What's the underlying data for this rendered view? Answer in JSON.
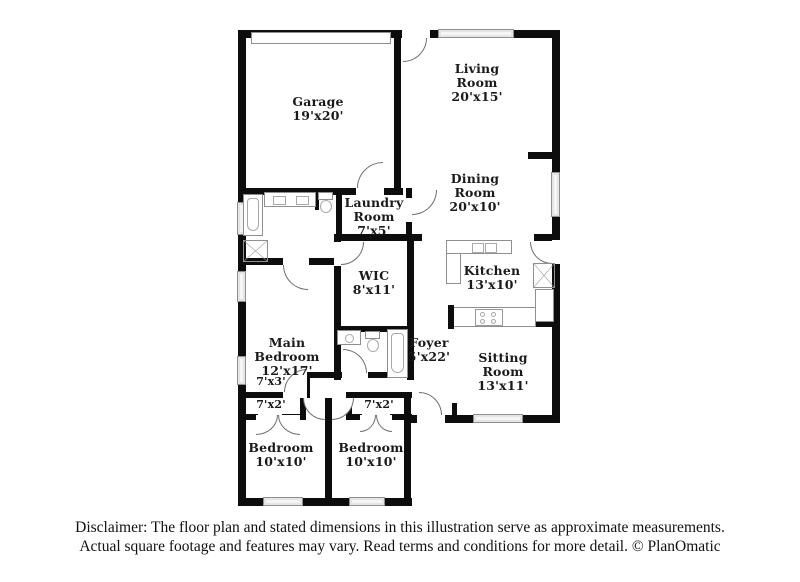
{
  "rooms": [
    {
      "id": "garage",
      "name": "Garage",
      "dims": "19'x20'"
    },
    {
      "id": "living-room",
      "name": "Living Room",
      "dims": "20'x15'"
    },
    {
      "id": "dining-room",
      "name": "Dining Room",
      "dims": "20'x10'"
    },
    {
      "id": "laundry-room",
      "name": "Laundry Room",
      "dims": "7'x5'"
    },
    {
      "id": "wic",
      "name": "WIC",
      "dims": "8'x11'"
    },
    {
      "id": "main-bedroom",
      "name": "Main Bedroom",
      "dims": "12'x17'"
    },
    {
      "id": "kitchen",
      "name": "Kitchen",
      "dims": "13'x10'"
    },
    {
      "id": "foyer",
      "name": "Foyer",
      "dims": "5'x22'"
    },
    {
      "id": "sitting-room",
      "name": "Sitting Room",
      "dims": "13'x11'"
    },
    {
      "id": "bedroom-1",
      "name": "Bedroom",
      "dims": "10'x10'"
    },
    {
      "id": "bedroom-2",
      "name": "Bedroom",
      "dims": "10'x10'"
    }
  ],
  "closets": [
    {
      "id": "hall-closet",
      "dims": "7'x3'"
    },
    {
      "id": "closet-1",
      "dims": "7'x2'"
    },
    {
      "id": "closet-2",
      "dims": "7'x2'"
    }
  ],
  "disclaimer": {
    "line1": "Disclaimer: The floor plan and stated dimensions in this illustration serve as approximate measurements.",
    "line2": "Actual square footage and features may vary. Read terms and conditions for more detail. © PlanOmatic"
  },
  "colors": {
    "wall": "#0d0d0d",
    "window_fill": "#e4e4e4",
    "fixture_line": "#8f8f8f",
    "background": "#ffffff",
    "text": "#1a1a1a"
  }
}
